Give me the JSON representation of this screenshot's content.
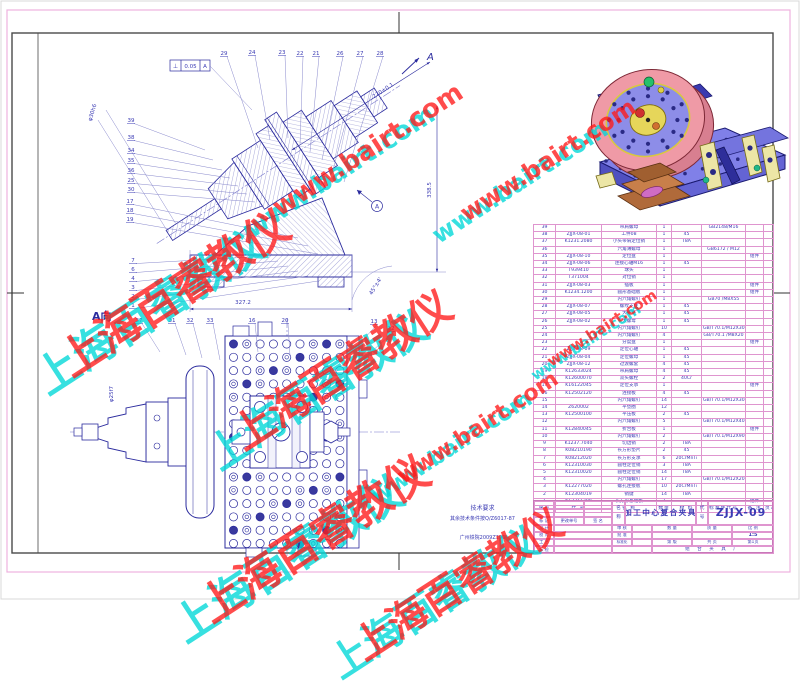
{
  "sheet": {
    "title": "加工中心复合夹具",
    "code": "ZJJX-09"
  },
  "colors": {
    "frame_pink": "#df95cf",
    "line_navy": "#2b2b9e",
    "text_blue": "#3b3bb4",
    "watermark_red": "#ff1a1a",
    "watermark_cyan": "#00d8d8"
  },
  "drawing": {
    "view_label": "A向",
    "arrow_label": "A",
    "datum_label": "A",
    "fcf": {
      "symbol": "⊥",
      "tolerance": "0.05",
      "datum": "A"
    },
    "dimensions": [
      {
        "text": "327.2",
        "x": 243,
        "y": 304,
        "rot": 0
      },
      {
        "text": "338.5",
        "x": 431,
        "y": 190,
        "rot": -90
      },
      {
        "text": "270±0.1",
        "x": 384,
        "y": 92,
        "rot": -33
      },
      {
        "text": "45°±4'",
        "x": 377,
        "y": 287,
        "rot": -58
      },
      {
        "text": "φ30h6",
        "x": 94,
        "y": 113,
        "rot": -73
      },
      {
        "text": "φ25f7",
        "x": 113,
        "y": 394,
        "rot": -90
      }
    ],
    "balloons": [
      {
        "label": "29",
        "x": 224,
        "y": 55,
        "tx": 258,
        "ty": 148
      },
      {
        "label": "24",
        "x": 252,
        "y": 54,
        "tx": 270,
        "ty": 140
      },
      {
        "label": "23",
        "x": 282,
        "y": 54,
        "tx": 288,
        "ty": 138
      },
      {
        "label": "22",
        "x": 300,
        "y": 55,
        "tx": 300,
        "ty": 145
      },
      {
        "label": "21",
        "x": 316,
        "y": 55,
        "tx": 310,
        "ty": 152
      },
      {
        "label": "26",
        "x": 340,
        "y": 55,
        "tx": 322,
        "ty": 160
      },
      {
        "label": "27",
        "x": 360,
        "y": 55,
        "tx": 333,
        "ty": 170
      },
      {
        "label": "28",
        "x": 380,
        "y": 55,
        "tx": 344,
        "ty": 182
      },
      {
        "label": "39",
        "x": 131,
        "y": 122,
        "tx": 205,
        "ty": 150
      },
      {
        "label": "38",
        "x": 131,
        "y": 139,
        "tx": 213,
        "ty": 160
      },
      {
        "label": "34",
        "x": 131,
        "y": 152,
        "tx": 222,
        "ty": 170
      },
      {
        "label": "35",
        "x": 131,
        "y": 162,
        "tx": 230,
        "ty": 178
      },
      {
        "label": "36",
        "x": 131,
        "y": 172,
        "tx": 238,
        "ty": 186
      },
      {
        "label": "25",
        "x": 131,
        "y": 182,
        "tx": 247,
        "ty": 194
      },
      {
        "label": "30",
        "x": 131,
        "y": 191,
        "tx": 255,
        "ty": 202
      },
      {
        "label": "17",
        "x": 130,
        "y": 203,
        "tx": 298,
        "ty": 238
      },
      {
        "label": "18",
        "x": 130,
        "y": 212,
        "tx": 308,
        "ty": 246
      },
      {
        "label": "19",
        "x": 130,
        "y": 221,
        "tx": 318,
        "ty": 254
      },
      {
        "label": "7",
        "x": 133,
        "y": 262,
        "tx": 268,
        "ty": 256
      },
      {
        "label": "6",
        "x": 133,
        "y": 271,
        "tx": 278,
        "ty": 261
      },
      {
        "label": "4",
        "x": 133,
        "y": 280,
        "tx": 288,
        "ty": 266
      },
      {
        "label": "3",
        "x": 133,
        "y": 289,
        "tx": 298,
        "ty": 271
      },
      {
        "label": "2",
        "x": 133,
        "y": 298,
        "tx": 308,
        "ty": 276
      },
      {
        "label": "1",
        "x": 133,
        "y": 307,
        "tx": 318,
        "ty": 281
      },
      {
        "label": "37",
        "x": 139,
        "y": 322,
        "tx": 160,
        "ty": 352
      },
      {
        "label": "31",
        "x": 172,
        "y": 322,
        "tx": 186,
        "ty": 355
      },
      {
        "label": "32",
        "x": 190,
        "y": 322,
        "tx": 202,
        "ty": 358
      },
      {
        "label": "33",
        "x": 210,
        "y": 322,
        "tx": 220,
        "ty": 360
      },
      {
        "label": "16",
        "x": 252,
        "y": 322,
        "tx": 258,
        "ty": 352
      },
      {
        "label": "20",
        "x": 285,
        "y": 322,
        "tx": 290,
        "ty": 356
      },
      {
        "label": "13",
        "x": 374,
        "y": 323,
        "tx": 352,
        "ty": 352
      },
      {
        "label": "12",
        "x": 391,
        "y": 330,
        "tx": 360,
        "ty": 362
      }
    ]
  },
  "notes": {
    "title": "技术要求",
    "line1": "其余技术条件按Q/Z6017-87",
    "line2": "广州铁院2009Z196"
  },
  "bom": {
    "headers": [
      "序号",
      "代  号",
      "名  称",
      "数量",
      "材 料",
      "标准件代号",
      "备 注",
      "页次"
    ],
    "rows": [
      [
        "39",
        "",
        "带肩螺母",
        "1",
        "",
        "GB2148/M16",
        "",
        ""
      ],
      [
        "38",
        "ZJJX-08-01",
        "工件08",
        "1",
        "45",
        "",
        "",
        ""
      ],
      [
        "37",
        "K1231.2080",
        "小头带肩定位销",
        "1",
        "T8A",
        "",
        "",
        ""
      ],
      [
        "36",
        "",
        "六角薄螺母",
        "1",
        "",
        "GB6172 / M12",
        "",
        ""
      ],
      [
        "35",
        "ZJJX-08-10",
        "定位盘",
        "1",
        "",
        "",
        "组件",
        ""
      ],
      [
        "34",
        "ZJJX-08-06",
        "连接心轴M16",
        "1",
        "45",
        "",
        "",
        ""
      ],
      [
        "33",
        "T939410",
        "球头",
        "1",
        "",
        "",
        "",
        ""
      ],
      [
        "32",
        "T371004",
        "对位销",
        "1",
        "",
        "",
        "",
        ""
      ],
      [
        "31",
        "ZJJX-08-03",
        "插板",
        "1",
        "",
        "",
        "组件",
        ""
      ],
      [
        "30",
        "K1234.1200",
        "圆形基础板",
        "1",
        "",
        "",
        "组件",
        ""
      ],
      [
        "29",
        "",
        "内六角螺钉",
        "1",
        "",
        "GB70 /M8X55",
        "",
        ""
      ],
      [
        "28",
        "ZJJX-08-07",
        "螺纹支柱",
        "1",
        "45",
        "",
        "",
        ""
      ],
      [
        "27",
        "ZJJX-08-05",
        "大平垫",
        "1",
        "45",
        "",
        "",
        ""
      ],
      [
        "26",
        "ZJJX-08-02",
        "大螺母",
        "1",
        "45",
        "",
        "",
        ""
      ],
      [
        "25",
        "",
        "内六角螺钉",
        "10",
        "",
        "GB/T70.1/M12X30",
        "",
        ""
      ],
      [
        "24",
        "",
        "内六角螺钉",
        "4",
        "",
        "GB/T70.1 /M8X20",
        "",
        ""
      ],
      [
        "23",
        "",
        "分度盘",
        "1",
        "",
        "",
        "组件",
        ""
      ],
      [
        "22",
        "ZJJX-08-09",
        "定位心轴",
        "1",
        "45",
        "",
        "",
        ""
      ],
      [
        "21",
        "ZJJX-08-04",
        "定位螺母",
        "1",
        "45",
        "",
        "",
        ""
      ],
      [
        "20",
        "ZJJX-08-12",
        "过渡螺套",
        "4",
        "45",
        "",
        "",
        ""
      ],
      [
        "19",
        "K12633024",
        "带肩螺母",
        "4",
        "45",
        "",
        "",
        ""
      ],
      [
        "18",
        "K12600070",
        "双头螺栓",
        "2",
        "40Cr",
        "",
        "",
        ""
      ],
      [
        "17",
        "K16122045",
        "定位支承",
        "1",
        "",
        "",
        "组件",
        ""
      ],
      [
        "16",
        "K12502120",
        "连接板",
        "4",
        "45",
        "",
        "",
        ""
      ],
      [
        "15",
        "",
        "内六角螺钉",
        "14",
        "",
        "GB/T70.1/M12X30",
        "",
        ""
      ],
      [
        "14",
        "Z620002",
        "平垫圈",
        "12",
        "",
        "",
        "",
        ""
      ],
      [
        "13",
        "K12500100",
        "平压板",
        "2",
        "45",
        "",
        "",
        ""
      ],
      [
        "12",
        "",
        "内六角螺钉",
        "5",
        "",
        "GB/T70.1/M12X40",
        "",
        ""
      ],
      [
        "11",
        "K12840045",
        "折合板",
        "1",
        "",
        "",
        "组件",
        ""
      ],
      [
        "10",
        "",
        "内六角螺钉",
        "2",
        "",
        "GB/T70.1/M12X90",
        "",
        ""
      ],
      [
        "9",
        "K1237.7040",
        "切边销",
        "2",
        "T8A",
        "",
        "",
        ""
      ],
      [
        "8",
        "K08210190",
        "长方形垫片",
        "2",
        "45",
        "",
        "",
        ""
      ],
      [
        "7",
        "K08212020",
        "长方形支承",
        "6",
        "20CrMnTi",
        "",
        "",
        ""
      ],
      [
        "6",
        "K12310030",
        "圆柱定位销",
        "3",
        "T8A",
        "",
        "",
        ""
      ],
      [
        "5",
        "K12310020",
        "圆柱定位销",
        "14",
        "T8A",
        "",
        "",
        ""
      ],
      [
        "4",
        "",
        "内六角螺钉",
        "17",
        "",
        "GB/T70.1/M12X20",
        "",
        ""
      ],
      [
        "3",
        "K12277020",
        "螺孔连接板",
        "10",
        "20CrMnTi",
        "",
        "",
        ""
      ],
      [
        "2",
        "K12304019",
        "销键",
        "14",
        "T8A",
        "",
        "",
        ""
      ],
      [
        "1",
        "K12311200",
        "长方形基础板",
        "2",
        "",
        "",
        "组件",
        ""
      ]
    ]
  },
  "title_block": {
    "name_label": "名称",
    "code_label": "代号",
    "title": "加工中心复合夹具",
    "code": "ZJJX-09",
    "change_labels": [
      "标 记",
      "更改单号",
      "签  名"
    ],
    "left_rows": [
      "设 计",
      "校 对",
      "工 艺",
      "标 检"
    ],
    "mid_rows": [
      "审 核",
      "批 准",
      "标准化"
    ],
    "qty_label": "数 量",
    "mass_label": "质 量",
    "scale_label": "比 例",
    "scale_value": "1:5",
    "edition_label": "第  版",
    "pages_label": "共  页",
    "page_label": "第1页",
    "company": "组 合 夹 具 厂"
  },
  "watermarks": [
    {
      "text": "www.bairt.com",
      "color": "#00d8d8",
      "x": 340,
      "y": 172,
      "size": 26,
      "rot": -33
    },
    {
      "text": "www.bairt.com",
      "color": "#ff1a1a",
      "x": 368,
      "y": 150,
      "size": 26,
      "rot": -33
    },
    {
      "text": "www.bairt.com",
      "color": "#00d8d8",
      "x": 520,
      "y": 182,
      "size": 24,
      "rot": -33
    },
    {
      "text": "www.bairt.com",
      "color": "#ff1a1a",
      "x": 548,
      "y": 160,
      "size": 24,
      "rot": -33
    },
    {
      "text": "www.bairt.com",
      "color": "#00d8d8",
      "x": 452,
      "y": 448,
      "size": 22,
      "rot": -33
    },
    {
      "text": "www.bairt.com",
      "color": "#ff1a1a",
      "x": 478,
      "y": 428,
      "size": 22,
      "rot": -33
    },
    {
      "text": "www.bairt.com",
      "color": "#00d8d8",
      "x": 586,
      "y": 342,
      "size": 15,
      "rot": -33
    },
    {
      "text": "www.bairt.com",
      "color": "#ff1a1a",
      "x": 602,
      "y": 328,
      "size": 15,
      "rot": -33
    },
    {
      "text": "上海百睿教仪",
      "color": "#00d8d8",
      "x": 148,
      "y": 308,
      "size": 44,
      "rot": -33
    },
    {
      "text": "上海百睿教仪",
      "color": "#ff1a1a",
      "x": 172,
      "y": 290,
      "size": 44,
      "rot": -33
    },
    {
      "text": "上海百睿教仪",
      "color": "#00d8d8",
      "x": 316,
      "y": 388,
      "size": 42,
      "rot": -33
    },
    {
      "text": "上海百睿教仪",
      "color": "#ff1a1a",
      "x": 340,
      "y": 368,
      "size": 42,
      "rot": -33
    },
    {
      "text": "上海百睿教仪",
      "color": "#00d8d8",
      "x": 286,
      "y": 556,
      "size": 44,
      "rot": -33
    },
    {
      "text": "上海百睿教仪",
      "color": "#ff1a1a",
      "x": 312,
      "y": 536,
      "size": 44,
      "rot": -33
    },
    {
      "text": "上海百睿教仪",
      "color": "#00d8d8",
      "x": 432,
      "y": 600,
      "size": 40,
      "rot": -33
    },
    {
      "text": "上海百睿教仪",
      "color": "#ff1a1a",
      "x": 456,
      "y": 582,
      "size": 40,
      "rot": -33
    }
  ]
}
